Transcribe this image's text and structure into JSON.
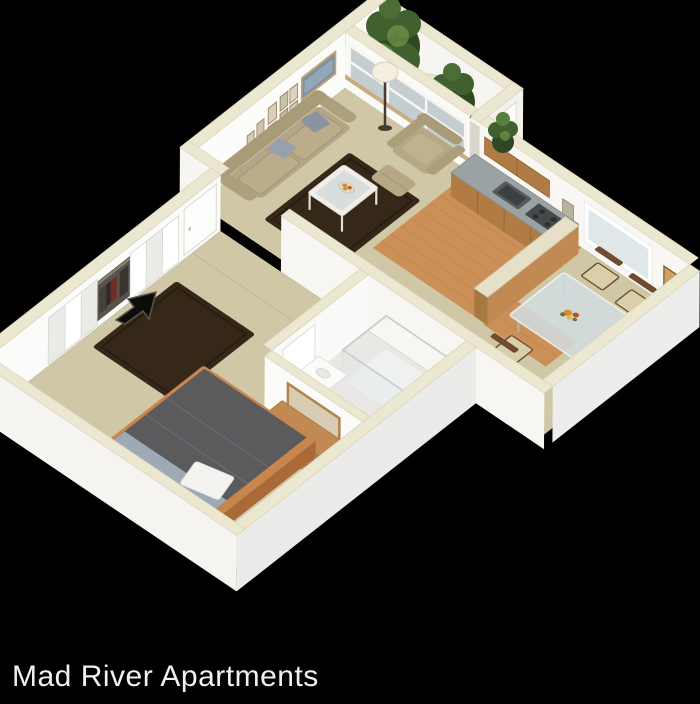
{
  "caption": {
    "text": "Mad River Apartments",
    "color": "#f1f1f1"
  },
  "scene": {
    "type": "3d-isometric-floor-plan-render",
    "background": "#000000",
    "rooms": [
      "balcony",
      "living-room",
      "kitchen",
      "dining-area",
      "entry-hall",
      "closet",
      "bathroom",
      "bedroom"
    ],
    "furnishings": {
      "living-room": [
        "sofa-with-pillows",
        "area-rug",
        "coffee-table-with-bowl",
        "armchair",
        "ottoman",
        "floor-lamp",
        "gallery-wall-frames",
        "window-band"
      ],
      "balcony": [
        "tree",
        "tree",
        "patio-table-with-umbrella"
      ],
      "kitchen": [
        "base-cabinets",
        "sink",
        "stove",
        "upper-cabinets",
        "bar-counter",
        "wood-floor"
      ],
      "dining-area": [
        "glass-table",
        "wood-chairs",
        "flower-centerpiece",
        "window",
        "wall-frames",
        "potted-plant",
        "door"
      ],
      "bathroom": [
        "shower-stall",
        "toilet",
        "vanity",
        "door"
      ],
      "bedroom": [
        "bed",
        "area-rug",
        "dresser",
        "wall-mirror",
        "bifold-closet-doors",
        "entry-door"
      ]
    },
    "entry_marker": "arrow-pointing-to-entrance"
  },
  "colors": {
    "background": "#000000",
    "wall_face": "#fafaf8",
    "wall_top": "#ece7d1",
    "carpet": "#cfc7a6",
    "wood_floor": "#cb9058",
    "rug": "#362818",
    "tree": "#40612e",
    "glass": "#b6c2c6",
    "cabinet_wood": "#b07c44",
    "mattress": "#5b5b5e",
    "caption_text": "#f1f1f1"
  }
}
